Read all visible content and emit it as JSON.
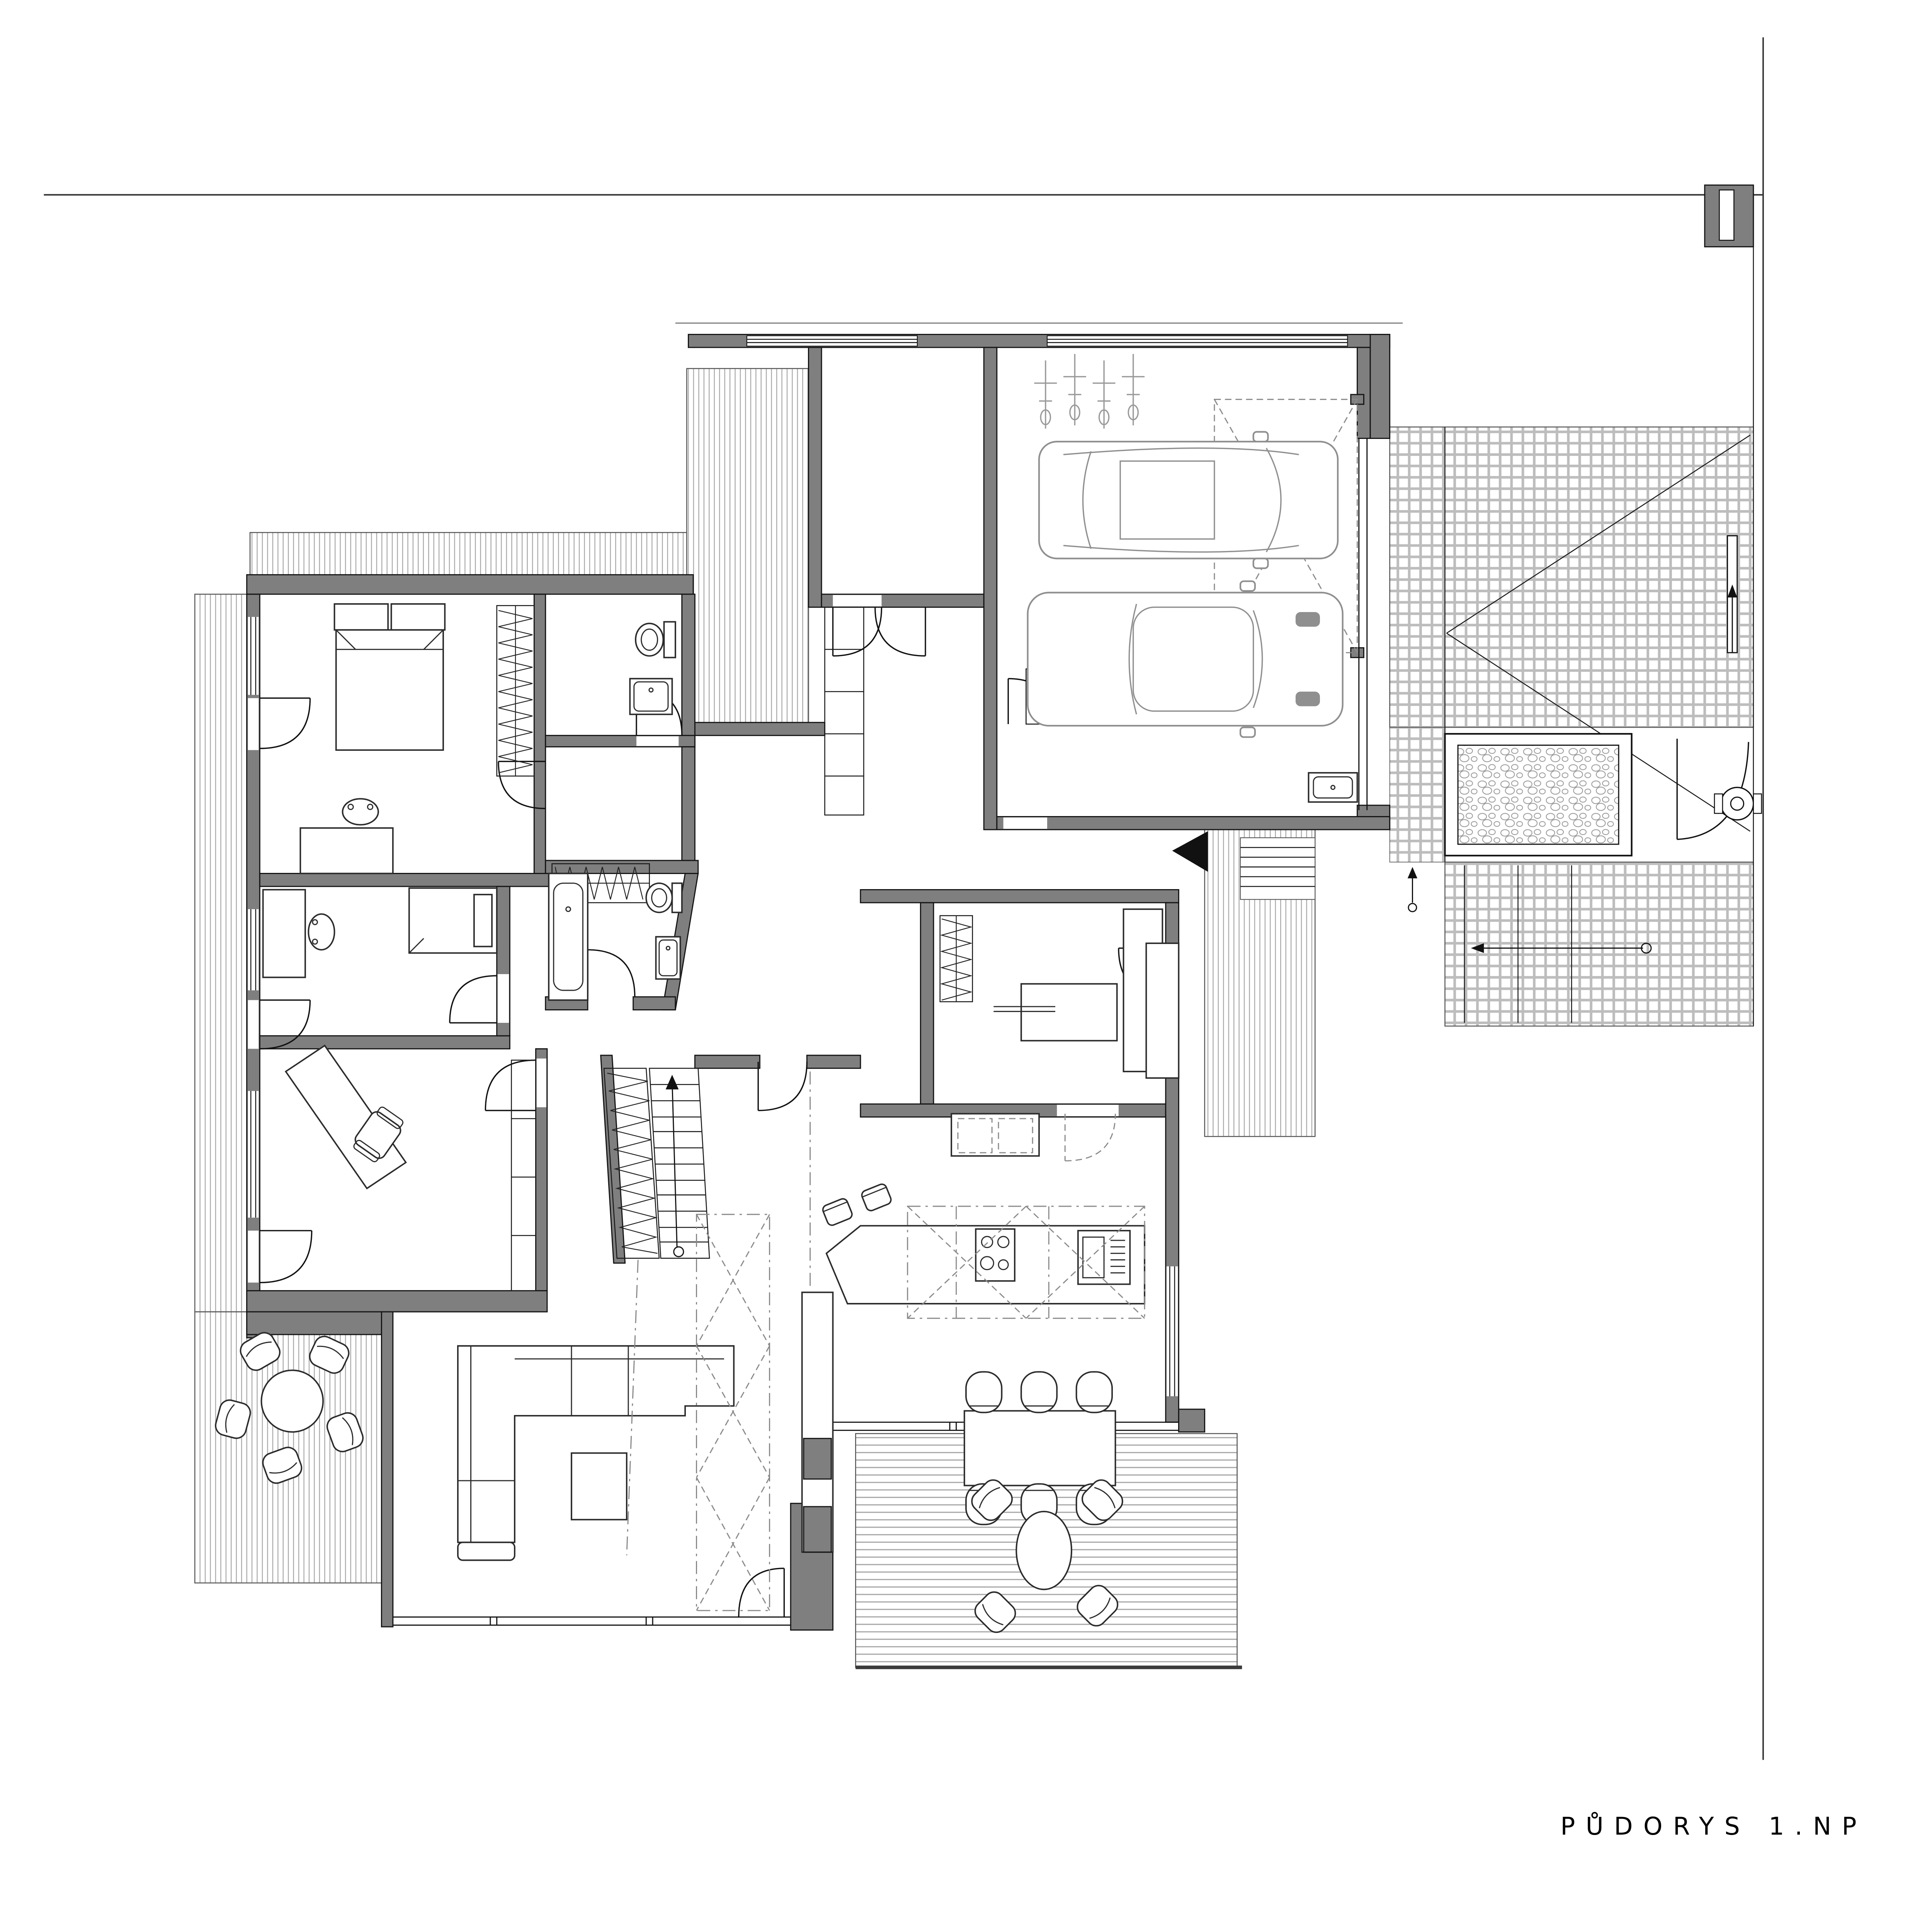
{
  "document": {
    "background": "#ffffff",
    "type_label_visible_text_count": 1
  },
  "title_block": {
    "label": "PŮDORYS 1.NP"
  },
  "palette": {
    "wall_fill": "#7f7f7f",
    "outline": "#141414",
    "furniture_line": "#2b2b2b",
    "car_line": "#8f8f8f",
    "deck_hatch_line": "#a6a6a6",
    "brick_joint": "#bdbdbd",
    "dashed_line": "#8a8a8a",
    "property_line": "#333333",
    "paper": "#ffffff"
  },
  "symbols": {
    "entry_marker": "black-triangle",
    "stair_direction": "arrow-with-circle-tail",
    "wardrobe": "zigzag-hatch",
    "terrace": "plank-hatch",
    "paving": "brick-grid",
    "planting_bed": "pebble-fill",
    "garage_door_envelope": "dashed-rect-with-x",
    "ceiling_feature": "dash-dot-diamond-strip"
  }
}
